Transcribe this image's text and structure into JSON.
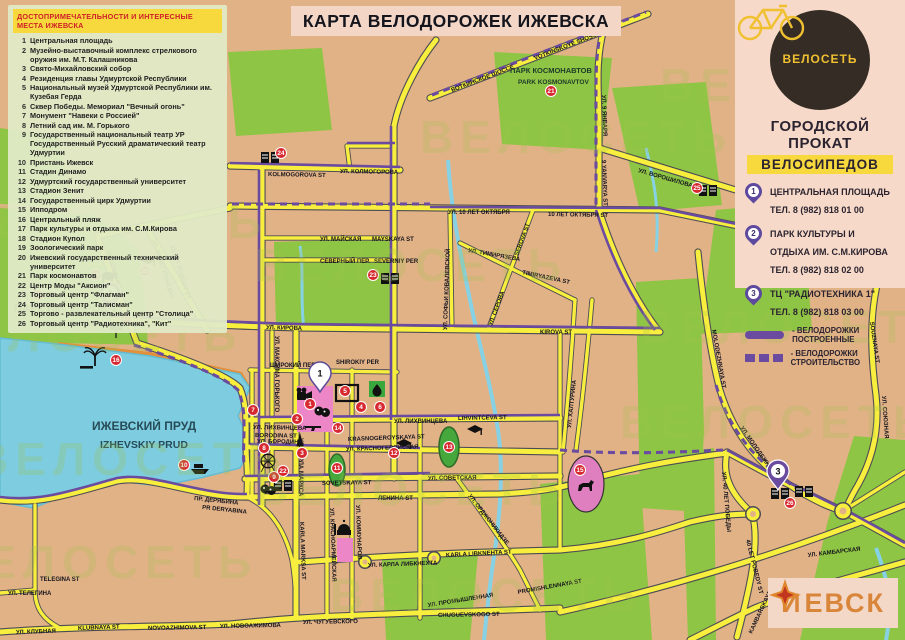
{
  "title": "КАРТА ВЕЛОДОРОЖЕК ИЖЕВСКА",
  "attractions": {
    "header": "ДОСТОПРИМЕЧАТЕЛЬНОСТИ И ИНТЕРЕСНЫЕ МЕСТА ИЖЕВСКА",
    "items": [
      {
        "num": "1",
        "text": "Центральная площадь"
      },
      {
        "num": "2",
        "text": "Музейно-выставочный комплекс стрелкового оружия им. М.Т. Калашникова"
      },
      {
        "num": "3",
        "text": "Свято-Михайловский собор"
      },
      {
        "num": "4",
        "text": "Резиденция главы Удмуртской Республики"
      },
      {
        "num": "5",
        "text": "Национальный музей Удмуртской Республики им. Кузебая Герда"
      },
      {
        "num": "6",
        "text": "Сквер Победы. Мемориал \"Вечный огонь\""
      },
      {
        "num": "7",
        "text": "Монумент \"Навеки с Россией\""
      },
      {
        "num": "8",
        "text": "Летний сад им. М. Горького"
      },
      {
        "num": "9",
        "text": "Государственный национальный театр УР Государственный Русский драматический театр Удмуртии"
      },
      {
        "num": "10",
        "text": "Пристань Ижевск"
      },
      {
        "num": "11",
        "text": "Стадин Динамо"
      },
      {
        "num": "12",
        "text": "Удмуртский государственный университет"
      },
      {
        "num": "13",
        "text": "Стадион Зенит"
      },
      {
        "num": "14",
        "text": "Государственный цирк Удмуртии"
      },
      {
        "num": "15",
        "text": "Ипподром"
      },
      {
        "num": "16",
        "text": "Центральный пляж"
      },
      {
        "num": "17",
        "text": "Парк культуры и отдыха им. С.М.Кирова"
      },
      {
        "num": "18",
        "text": "Стадион Купол"
      },
      {
        "num": "19",
        "text": "Зоологический парк"
      },
      {
        "num": "20",
        "text": "Ижевский государственный технический университет"
      },
      {
        "num": "21",
        "text": "Парк космонавтов"
      },
      {
        "num": "22",
        "text": "Центр Моды \"Аксион\""
      },
      {
        "num": "23",
        "text": "Торговый центр \"Флагман\""
      },
      {
        "num": "24",
        "text": "Торговый центр \"Талисман\""
      },
      {
        "num": "25",
        "text": "Торгово - развлекательный центр \"Столица\""
      },
      {
        "num": "26",
        "text": "Торговый центр \"Радиотехника\", \"Кит\""
      }
    ]
  },
  "brand": {
    "name": "ВЕЛОСЕТЬ",
    "tagline1": "ГОРОДСКОЙ ПРОКАТ",
    "tagline2": "ВЕЛОСИПЕДОВ",
    "watermark": "ВЕЛОСЕТЬ"
  },
  "rental_points": [
    {
      "num": "1",
      "name": "ЦЕНТРАЛЬНАЯ ПЛОЩАДЬ",
      "phone": "ТЕЛ. 8 (982) 818 01 00"
    },
    {
      "num": "2",
      "name": "ПАРК КУЛЬТУРЫ И ОТДЫХА ИМ. С.М.КИРОВА",
      "phone": "ТЕЛ. 8 (982) 818 02 00"
    },
    {
      "num": "3",
      "name": "ТЦ \"РАДИОТЕХНИКА 1\"",
      "phone": "ТЕЛ. 8 (982) 818 03 00"
    }
  ],
  "path_legend": {
    "built": "- ВЕЛОДОРОЖКИ ПОСТРОЕННЫЕ",
    "under_construction": "- ВЕЛОДОРОЖКИ СТРОИТЕЛЬСТВО"
  },
  "places": {
    "park_kirova_ru": "ПАРК ИМ. КИРОВА",
    "park_kirova_en": "PARK KIROVA",
    "pond_ru": "ИЖЕВСКИЙ ПРУД",
    "pond_en": "IZHEVSKIY PRUD",
    "kosmonavtov_ru": "ПАРК КОСМОНАВТОВ",
    "kosmonavtov_en": "PARK KOSMONAVTOV"
  },
  "streets": {
    "kolmogorova_en": "KOLMOGOROVA ST",
    "kolmogorova_ru": "УЛ. КОЛМОГОРОВА",
    "okt10_ru": "УЛ. 10 ЛЕТ ОКТЯБРЯ",
    "okt10_en": "10 ЛЕТ ОКТЯБРЯ ST",
    "mayskaya_ru": "УЛ. МАЙСКАЯ",
    "mayskaya_en": "MAYSKAYA ST",
    "severniy_ru": "СЕВЕРНЫЙ ПЕР.",
    "severniy_en": "SEVERNIY PER",
    "votkinskoye_ru": "ВОТКИНСКОЕ ШОССЕ",
    "votkinskoye_en": "VOTKINSKOYE SHOSSE",
    "yanvarya9_ru": "УЛ. 9 ЯНВАРЯ",
    "yanvarya9_en": "9 YANVARYA ST",
    "voroshilova_ru": "УЛ. ВОРОШИЛОВА",
    "voroshilova_en": "VOROSHILOVA ST",
    "kirova_ru": "УЛ. КИРОВА",
    "kirova_en": "KIROVA ST",
    "pobedy30_ru": "УЛ. 30 ЛЕТ ПОБЕДЫ",
    "pobedy30_en": "30 LET POBEDY ST",
    "pesochnaya_ru": "ПЕСОЧНАЯ ST",
    "lihvintceva_ru": "УЛ. ЛИХВИНЦЕВА",
    "lihvintceva_en": "LIHVINTCEVA ST",
    "borodina_ru": "УЛ. БОРОДИНА",
    "borodina_en": "BORODINA ST",
    "krasnogeroyskaya_ru": "УЛ. КРАСНОГЕРОЙСКАЯ",
    "krasnogeroyskaya_en": "KRASNOGEROYSKAYA ST",
    "sovetskaya_ru": "УЛ. СОВЕТСКАЯ",
    "sovetskaya_en": "SOVETSKAYA ST",
    "lenina_en": "ЛЕНИНА ST",
    "karlamarksa_ru": "УЛ. КАРЛА МАРКСА",
    "karlamarksa_en": "KARLA MARKSA ST",
    "gorkogo_ru": "УЛ. МАКСИМА ГОРЬКОГО",
    "kommunarov_ru": "УЛ. КОММУНАРОВ",
    "krasnoarmeyskaya_ru": "УЛ. КРАСНОАРМЕЙСКАЯ",
    "libknehta_ru": "УЛ. КАРЛА ЛИБКНЕХТА",
    "libknehta_en": "KARLA LIBKNEHTA ST",
    "promishlennaya_ru": "УЛ. ПРОМЫШЛЕННАЯ",
    "promishlennaya_en": "PROMISHLENNAYA ST",
    "chuguevskogo_ru": "УЛ. ЧУГУЕВСКОГО",
    "chuguevskogo_en": "CHUGUEVSKOGO ST",
    "klubnaya_ru": "УЛ. КЛУБНАЯ",
    "klubnaya_en": "KLUBNAYA ST",
    "novoazhimova_ru": "УЛ. НОВОАЖИМОВА",
    "novoazhimova_en": "NOVOAZHIMOVA ST",
    "telegina_ru": "УЛ. ТЕЛЕГИНА",
    "telegina_en": "TELEGINA ST",
    "deryabina_ru": "ПР. ДЕРЯБИНА",
    "deryabina_en": "PR DERYABINA",
    "molodezhnaya_ru": "УЛ. МОЛОДЕЖНАЯ",
    "molodezhnaya_en": "MOLODEZHNAYA ST",
    "souznaya_ru": "УЛ. СОЮЗНАЯ",
    "souznaya_en": "SOUZNAYA ST",
    "pobedy40_ru": "УЛ. 40 ЛЕТ ПОБЕДЫ",
    "pobedy40_en": "40 LET POBEDY ST",
    "kambarskaya_ru": "УЛ. КАМБАРСКАЯ",
    "kambarskaya_en": "KAMBARSKAYA ST",
    "timiryazeva_ru": "УЛ. ТИМИРЯЗЕВА",
    "timiryazeva_en": "TIMIRYAZEVA ST",
    "serova_ru": "УЛ. СЕРОВА",
    "serova_en": "SEROVA ST",
    "kovalevskoy_ru": "УЛ. СОФЬИ КОВАЛЕВСКОЙ",
    "halturina_ru": "УЛ. ХАЛТУРИНА",
    "ordzhonikidze_ru": "УЛ. ОРДЖОНИКИДЗЕ",
    "shirokiy_ru": "ШИРОКИЙ ПЕР.",
    "shirokiy_en": "SHIROKIY PER"
  },
  "markers": {
    "m1": "1",
    "m2": "2",
    "m3": "3",
    "m4": "4",
    "m5": "5",
    "m6": "6",
    "m7": "7",
    "m8": "8",
    "m9": "9",
    "m10": "10",
    "m11": "11",
    "m12": "12",
    "m13": "13",
    "m14": "14",
    "m15": "15",
    "m16": "16",
    "m17": "17",
    "m18": "18",
    "m19": "19",
    "m20": "20",
    "m21": "21",
    "m22": "22",
    "m23": "23",
    "m24": "24",
    "m25": "25",
    "m26": "26"
  },
  "pins": {
    "p1": "1",
    "p2": "2",
    "p3": "3"
  },
  "city_logo": {
    "prefix": "И",
    "suffix": "ЕВСК"
  },
  "colors": {
    "bike_path": "#6a4b9f",
    "road": "#f7ee3e",
    "water": "#7eccdf",
    "park": "#8fc544",
    "marker_red": "#d7282f"
  }
}
